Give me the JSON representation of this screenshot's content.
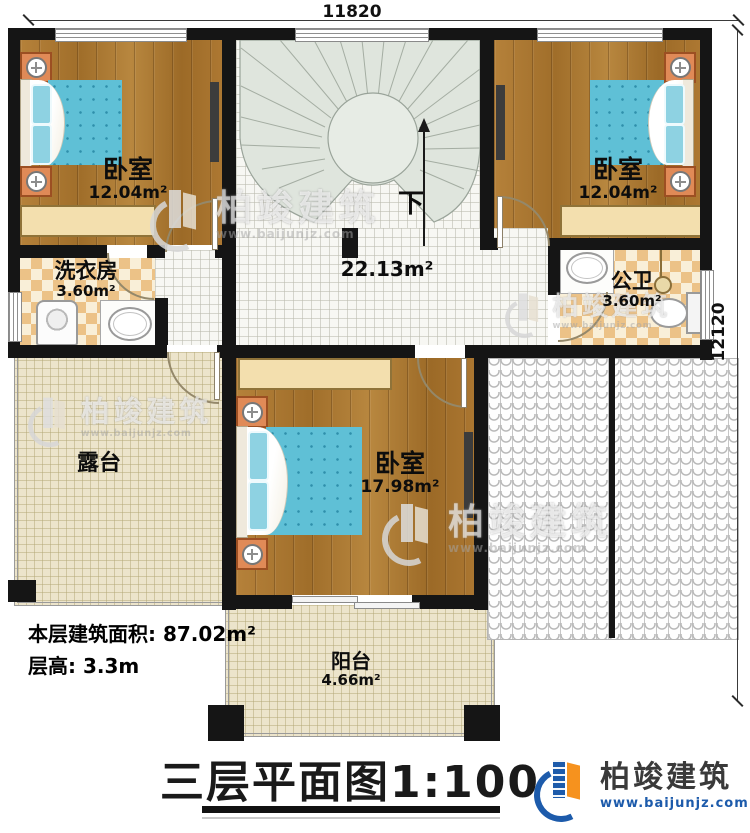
{
  "dimensions": {
    "top": "11820",
    "right": "12120"
  },
  "rooms": {
    "bedroom_tl": {
      "name": "卧室",
      "area": "12.04m²"
    },
    "bedroom_tr": {
      "name": "卧室",
      "area": "12.04m²"
    },
    "laundry": {
      "name": "洗衣房",
      "area": "3.60m²"
    },
    "hall": {
      "area": "22.13m²"
    },
    "bathroom": {
      "name": "公卫",
      "area": "3.60m²"
    },
    "terrace": {
      "name": "露台"
    },
    "bedroom_main": {
      "name": "卧室",
      "area": "17.98m²"
    },
    "balcony": {
      "name": "阳台",
      "area": "4.66m²"
    }
  },
  "stairs": {
    "direction_label": "下"
  },
  "summary": {
    "floor_area_label": "本层建筑面积:",
    "floor_area_value": "87.02m²",
    "floor_height_label": "层高:",
    "floor_height_value": "3.3m"
  },
  "title": "三层平面图1:100",
  "brand": {
    "name": "柏竣建筑",
    "website": "www.baijunjz.com"
  },
  "watermark": {
    "name": "柏竣建筑",
    "website": "www.baijunjz.com"
  },
  "colors": {
    "wall": "#151515",
    "wood": "#a9762f",
    "mattress": "#5fc0d6",
    "stair": "#dfe5dd",
    "brand_blue": "#1d5bab",
    "brand_orange": "#f6921e"
  }
}
